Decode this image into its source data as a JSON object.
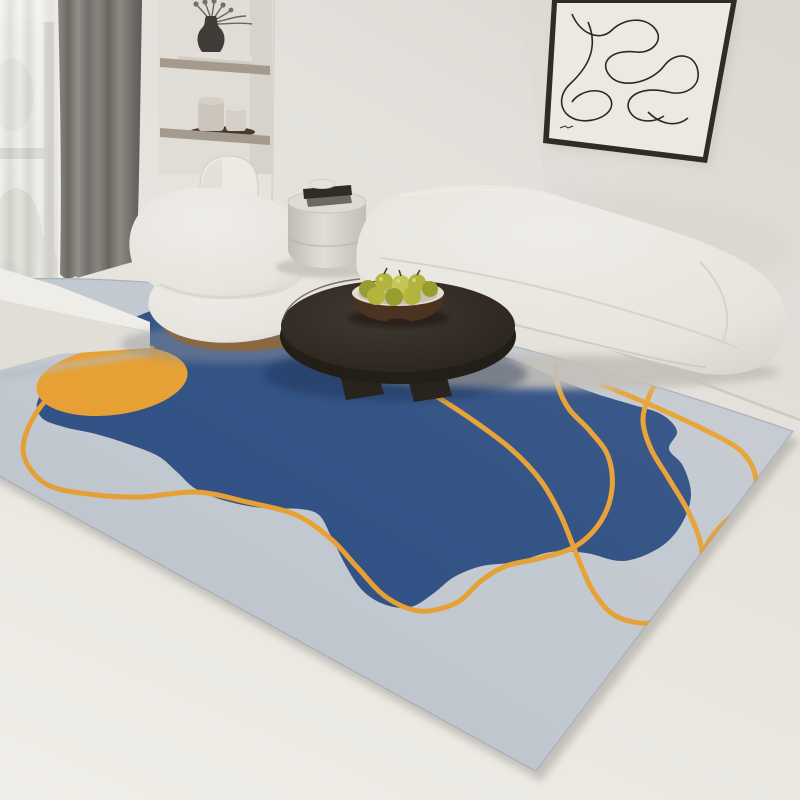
{
  "scene": {
    "description": "Photograph of a bright modern living room: abstract area rug in light grey with a navy organic blob, amber circle and amber squiggle lines; curved white boucle sofa; round white boucle armchair; dark oval wood coffee table with a bowl of green pears; grey drum side table with books; framed one-line abstract wall art; recessed wall shelves with vase and dried stems; window with grey curtain and white sheer.",
    "objects": [
      "wall",
      "floor",
      "window",
      "sheer-curtain",
      "blackout-curtain",
      "window-bench",
      "shelf-niche",
      "vase",
      "dried-stems",
      "arched-niche",
      "wall-art",
      "area-rug",
      "armchair",
      "side-table",
      "sofa",
      "coffee-table",
      "fruit-bowl",
      "pears",
      "baseboard"
    ]
  },
  "colors": {
    "wall": "#ece9e3",
    "wall-dark": "#dfdcd5",
    "floor": "#f4f2ec",
    "rug-field": "#c9cfd6",
    "rug-blue": "#2c4e85",
    "rug-orange": "#f0a42e",
    "curtain": "#86807a",
    "sheer": "#f8f7f4",
    "frame": "#2f2c28",
    "paper": "#f2efe9",
    "ink": "#2b2824",
    "shelf": "#a89d90",
    "vase": "#413d39",
    "tray": "#4c392a",
    "canister": "#d0cac1",
    "canister2": "#dad4cc",
    "bench": "#f5f3ee",
    "bench-side": "#e7e4dd",
    "sofa": "#efece6",
    "chair": "#f1eee8",
    "wood": "#8d6a45",
    "table": "#362f27",
    "table-side": "#221d17",
    "table-leg": "#29231c",
    "bowl": "#4c3322",
    "bowl-rim": "#e9e2d6",
    "bowl-inner": "#cfc5b4",
    "pear": "#b5b93e",
    "pear-dark": "#9aa22f",
    "pear-light": "#c9ca55",
    "book": "#2f2b27",
    "book2": "#716b63",
    "dish": "#edeae4",
    "foliage": "#5f7a54",
    "foliage-dark": "#435c3d",
    "baseboard": "#d3cfc8",
    "shadow-navy": "#16294c"
  },
  "rug": {
    "outline": {
      "top_left": [
        -20,
        280
      ],
      "top_control": [
        300,
        260
      ],
      "right": [
        794,
        431
      ],
      "bottom": [
        536,
        772
      ],
      "left_bottom": [
        -20,
        466
      ]
    },
    "blob_points": [
      [
        168,
        306
      ],
      [
        130,
        320
      ],
      [
        95,
        345
      ],
      [
        60,
        372
      ],
      [
        38,
        400
      ],
      [
        42,
        418
      ],
      [
        64,
        427
      ],
      [
        96,
        434
      ],
      [
        128,
        444
      ],
      [
        158,
        456
      ],
      [
        177,
        472
      ],
      [
        196,
        489
      ],
      [
        226,
        501
      ],
      [
        263,
        508
      ],
      [
        300,
        509
      ],
      [
        319,
        515
      ],
      [
        331,
        536
      ],
      [
        346,
        566
      ],
      [
        363,
        591
      ],
      [
        386,
        605
      ],
      [
        411,
        607
      ],
      [
        434,
        593
      ],
      [
        454,
        577
      ],
      [
        482,
        566
      ],
      [
        516,
        562
      ],
      [
        551,
        552
      ],
      [
        586,
        553
      ],
      [
        623,
        561
      ],
      [
        659,
        548
      ],
      [
        681,
        525
      ],
      [
        691,
        495
      ],
      [
        683,
        466
      ],
      [
        669,
        449
      ],
      [
        677,
        431
      ],
      [
        661,
        414
      ],
      [
        630,
        404
      ],
      [
        597,
        394
      ],
      [
        560,
        380
      ],
      [
        520,
        362
      ],
      [
        476,
        348
      ],
      [
        426,
        334
      ],
      [
        373,
        322
      ],
      [
        316,
        311
      ],
      [
        261,
        303
      ],
      [
        210,
        302
      ]
    ],
    "circle": {
      "cx": 112,
      "cy": 381,
      "rx": 76,
      "ry": 34,
      "rotate": -7
    },
    "line_width": 5,
    "lines": [
      {
        "points": [
          [
            152,
            348
          ],
          [
            102,
            360
          ],
          [
            56,
            390
          ],
          [
            30,
            424
          ],
          [
            24,
            456
          ],
          [
            46,
            484
          ],
          [
            88,
            494
          ],
          [
            140,
            497
          ],
          [
            196,
            492
          ],
          [
            247,
            502
          ],
          [
            296,
            515
          ],
          [
            331,
            539
          ],
          [
            357,
            567
          ],
          [
            386,
            597
          ],
          [
            420,
            611
          ],
          [
            456,
            603
          ],
          [
            481,
            581
          ],
          [
            506,
            566
          ],
          [
            541,
            558
          ],
          [
            576,
            546
          ],
          [
            601,
            521
          ],
          [
            612,
            489
          ],
          [
            608,
            456
          ],
          [
            590,
            431
          ],
          [
            569,
            409
          ],
          [
            558,
            386
          ],
          [
            556,
            366
          ]
        ]
      },
      {
        "points": [
          [
            250,
            316
          ],
          [
            300,
            331
          ],
          [
            346,
            350
          ],
          [
            391,
            369
          ],
          [
            431,
            393
          ],
          [
            471,
            419
          ],
          [
            511,
            449
          ],
          [
            541,
            481
          ],
          [
            561,
            516
          ],
          [
            576,
            553
          ],
          [
            593,
            591
          ],
          [
            616,
            616
          ],
          [
            651,
            623
          ],
          [
            684,
            608
          ],
          [
            701,
            581
          ],
          [
            701,
            546
          ],
          [
            689,
            513
          ],
          [
            669,
            479
          ],
          [
            651,
            449
          ],
          [
            643,
            421
          ],
          [
            649,
            396
          ],
          [
            661,
            373
          ]
        ]
      },
      {
        "points": [
          [
            601,
            384
          ],
          [
            651,
            405
          ],
          [
            701,
            428
          ],
          [
            741,
            451
          ],
          [
            756,
            479
          ],
          [
            749,
            506
          ],
          [
            726,
            521
          ],
          [
            706,
            546
          ],
          [
            699,
            576
          ],
          [
            706,
            601
          ],
          [
            719,
            616
          ]
        ]
      }
    ]
  }
}
